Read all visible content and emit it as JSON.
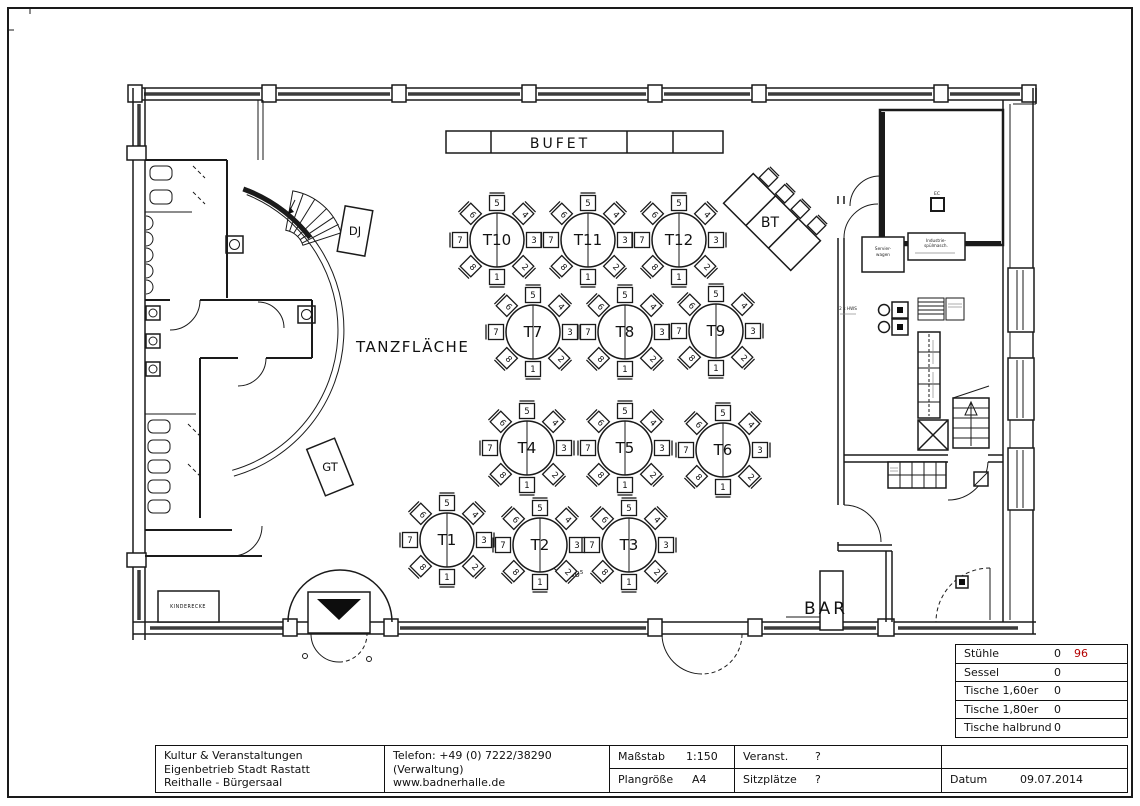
{
  "plan": {
    "labels": {
      "bufet": "BUFET",
      "tanzflaeche": "TANZFLÄCHE",
      "bar": "BAR",
      "dj": "DJ",
      "gt": "GT",
      "bt": "BT",
      "kinderecke": "KINDERECKE",
      "ec": "EC",
      "measure": "1,00",
      "measure_sup": "5"
    },
    "equipment": {
      "servierwagen_l1": "Servier-",
      "servierwagen_l2": "wagen",
      "spuelmasch_l1": "Industrie-",
      "spuelmasch_l2": "spülmasch.",
      "hws": "2 x HWS"
    },
    "tables": [
      {
        "label": "T1",
        "x": 447,
        "y": 540
      },
      {
        "label": "T2",
        "x": 540,
        "y": 545
      },
      {
        "label": "T3",
        "x": 629,
        "y": 545
      },
      {
        "label": "T4",
        "x": 527,
        "y": 448
      },
      {
        "label": "T5",
        "x": 625,
        "y": 448
      },
      {
        "label": "T6",
        "x": 723,
        "y": 450
      },
      {
        "label": "T7",
        "x": 533,
        "y": 332
      },
      {
        "label": "T8",
        "x": 625,
        "y": 332
      },
      {
        "label": "T9",
        "x": 716,
        "y": 331
      },
      {
        "label": "T10",
        "x": 497,
        "y": 240
      },
      {
        "label": "T11",
        "x": 588,
        "y": 240
      },
      {
        "label": "T12",
        "x": 679,
        "y": 240
      }
    ],
    "chairs": [
      {
        "n": "1",
        "deg": 90
      },
      {
        "n": "2",
        "deg": 45
      },
      {
        "n": "3",
        "deg": 0
      },
      {
        "n": "4",
        "deg": 315
      },
      {
        "n": "5",
        "deg": 270
      },
      {
        "n": "6",
        "deg": 225
      },
      {
        "n": "7",
        "deg": 180
      },
      {
        "n": "8",
        "deg": 135
      }
    ]
  },
  "legend": {
    "rows": [
      {
        "label": "Stühle",
        "value": "0",
        "extra": "96"
      },
      {
        "label": "Sessel",
        "value": "0",
        "extra": ""
      },
      {
        "label": "Tische 1,60er",
        "value": "0",
        "extra": ""
      },
      {
        "label": "Tische 1,80er",
        "value": "0",
        "extra": ""
      },
      {
        "label": "Tische halbrund",
        "value": "0",
        "extra": ""
      }
    ]
  },
  "title_block": {
    "org_l1": "Kultur & Veranstaltungen",
    "org_l2": "Eigenbetrieb Stadt Rastatt",
    "org_l3": "Reithalle - Bürgersaal",
    "contact_l1": "Telefon: +49 (0) 7222/38290",
    "contact_l2": "(Verwaltung)",
    "contact_l3": "www.badnerhalle.de",
    "masstab_label": "Maßstab",
    "masstab_value": "1:150",
    "plangroesse_label": "Plangröße",
    "plangroesse_value": "A4",
    "veranst_label": "Veranst.",
    "veranst_value": "?",
    "sitzplaetze_label": "Sitzplätze",
    "sitzplaetze_value": "?",
    "datum_label": "Datum",
    "datum_value": "09.07.2014"
  }
}
